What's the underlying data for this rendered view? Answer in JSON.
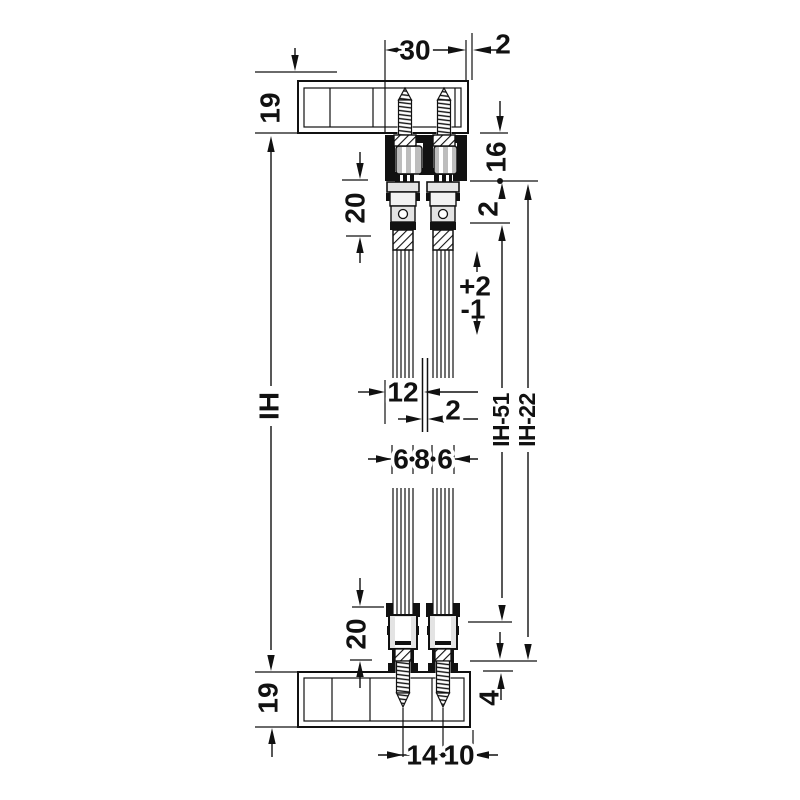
{
  "drawing": {
    "kind": "sliding-door-fitting-cross-section",
    "colors": {
      "line": "#111111",
      "roller_gray": "#bdbdbd",
      "profile_light": "#e3e3e3",
      "background": "#ffffff"
    }
  },
  "dimensions": {
    "track_width": "30",
    "wall_gap_top": "2",
    "top_panel_thickness": "19",
    "track_height": "16",
    "top_profile_height": "20",
    "track_bottom_gap": "2",
    "height_adjust_plus": "+2",
    "height_adjust_minus": "-1",
    "inner_height": "IH",
    "door_thickness": "12",
    "door_gap": "2",
    "glass_left": "6",
    "glass_mid": "8",
    "glass_right": "6",
    "ih_minus_51": "IH-51",
    "ih_minus_22": "IH-22",
    "bottom_profile_height": "20",
    "bottom_inset": "4",
    "bottom_panel_thickness": "19",
    "screw_spacing": "14",
    "edge_distance": "10"
  }
}
